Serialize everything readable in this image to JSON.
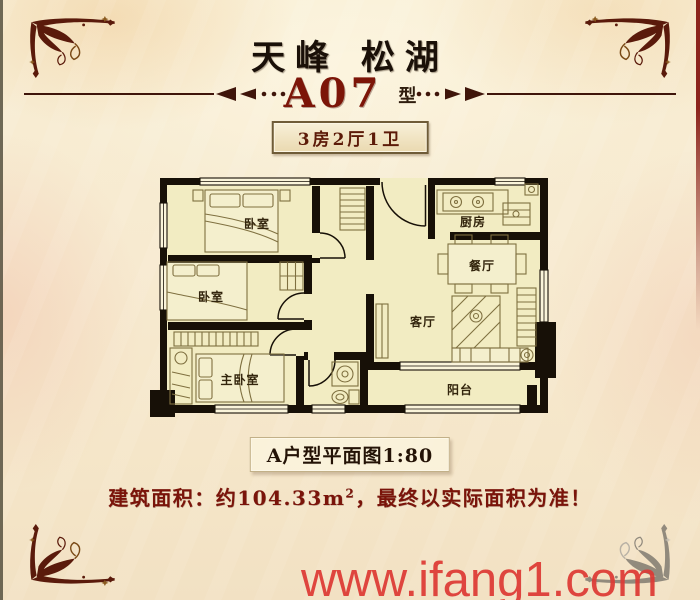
{
  "header": {
    "title": "天峰 松湖",
    "unit_code": "A07",
    "unit_suffix": "型",
    "badge": "3房2厅1卫"
  },
  "floorplan": {
    "rooms": [
      {
        "id": "bedroom-1",
        "label": "卧室"
      },
      {
        "id": "bedroom-2",
        "label": "卧室"
      },
      {
        "id": "master-bedroom",
        "label": "主卧室"
      },
      {
        "id": "kitchen",
        "label": "厨房"
      },
      {
        "id": "dining-room",
        "label": "餐厅"
      },
      {
        "id": "living-room",
        "label": "客厅"
      },
      {
        "id": "balcony",
        "label": "阳台"
      }
    ],
    "caption": "A户型平面图1:80"
  },
  "footer": {
    "area_note": {
      "prefix": "建筑面积：约104.33m",
      "sup": "2",
      "suffix": "，最终以实际面积为准！"
    },
    "watermark": "www.ifang1.com"
  },
  "colors": {
    "accent_red": "#7c1508",
    "badge_text": "#5c1a08",
    "wall_black": "#171007",
    "room_fill": "#f2ecc2",
    "watermark_red": "#dd3934",
    "ornament_brown": "#5a1a0b",
    "background_cream": "#f7ead0"
  }
}
